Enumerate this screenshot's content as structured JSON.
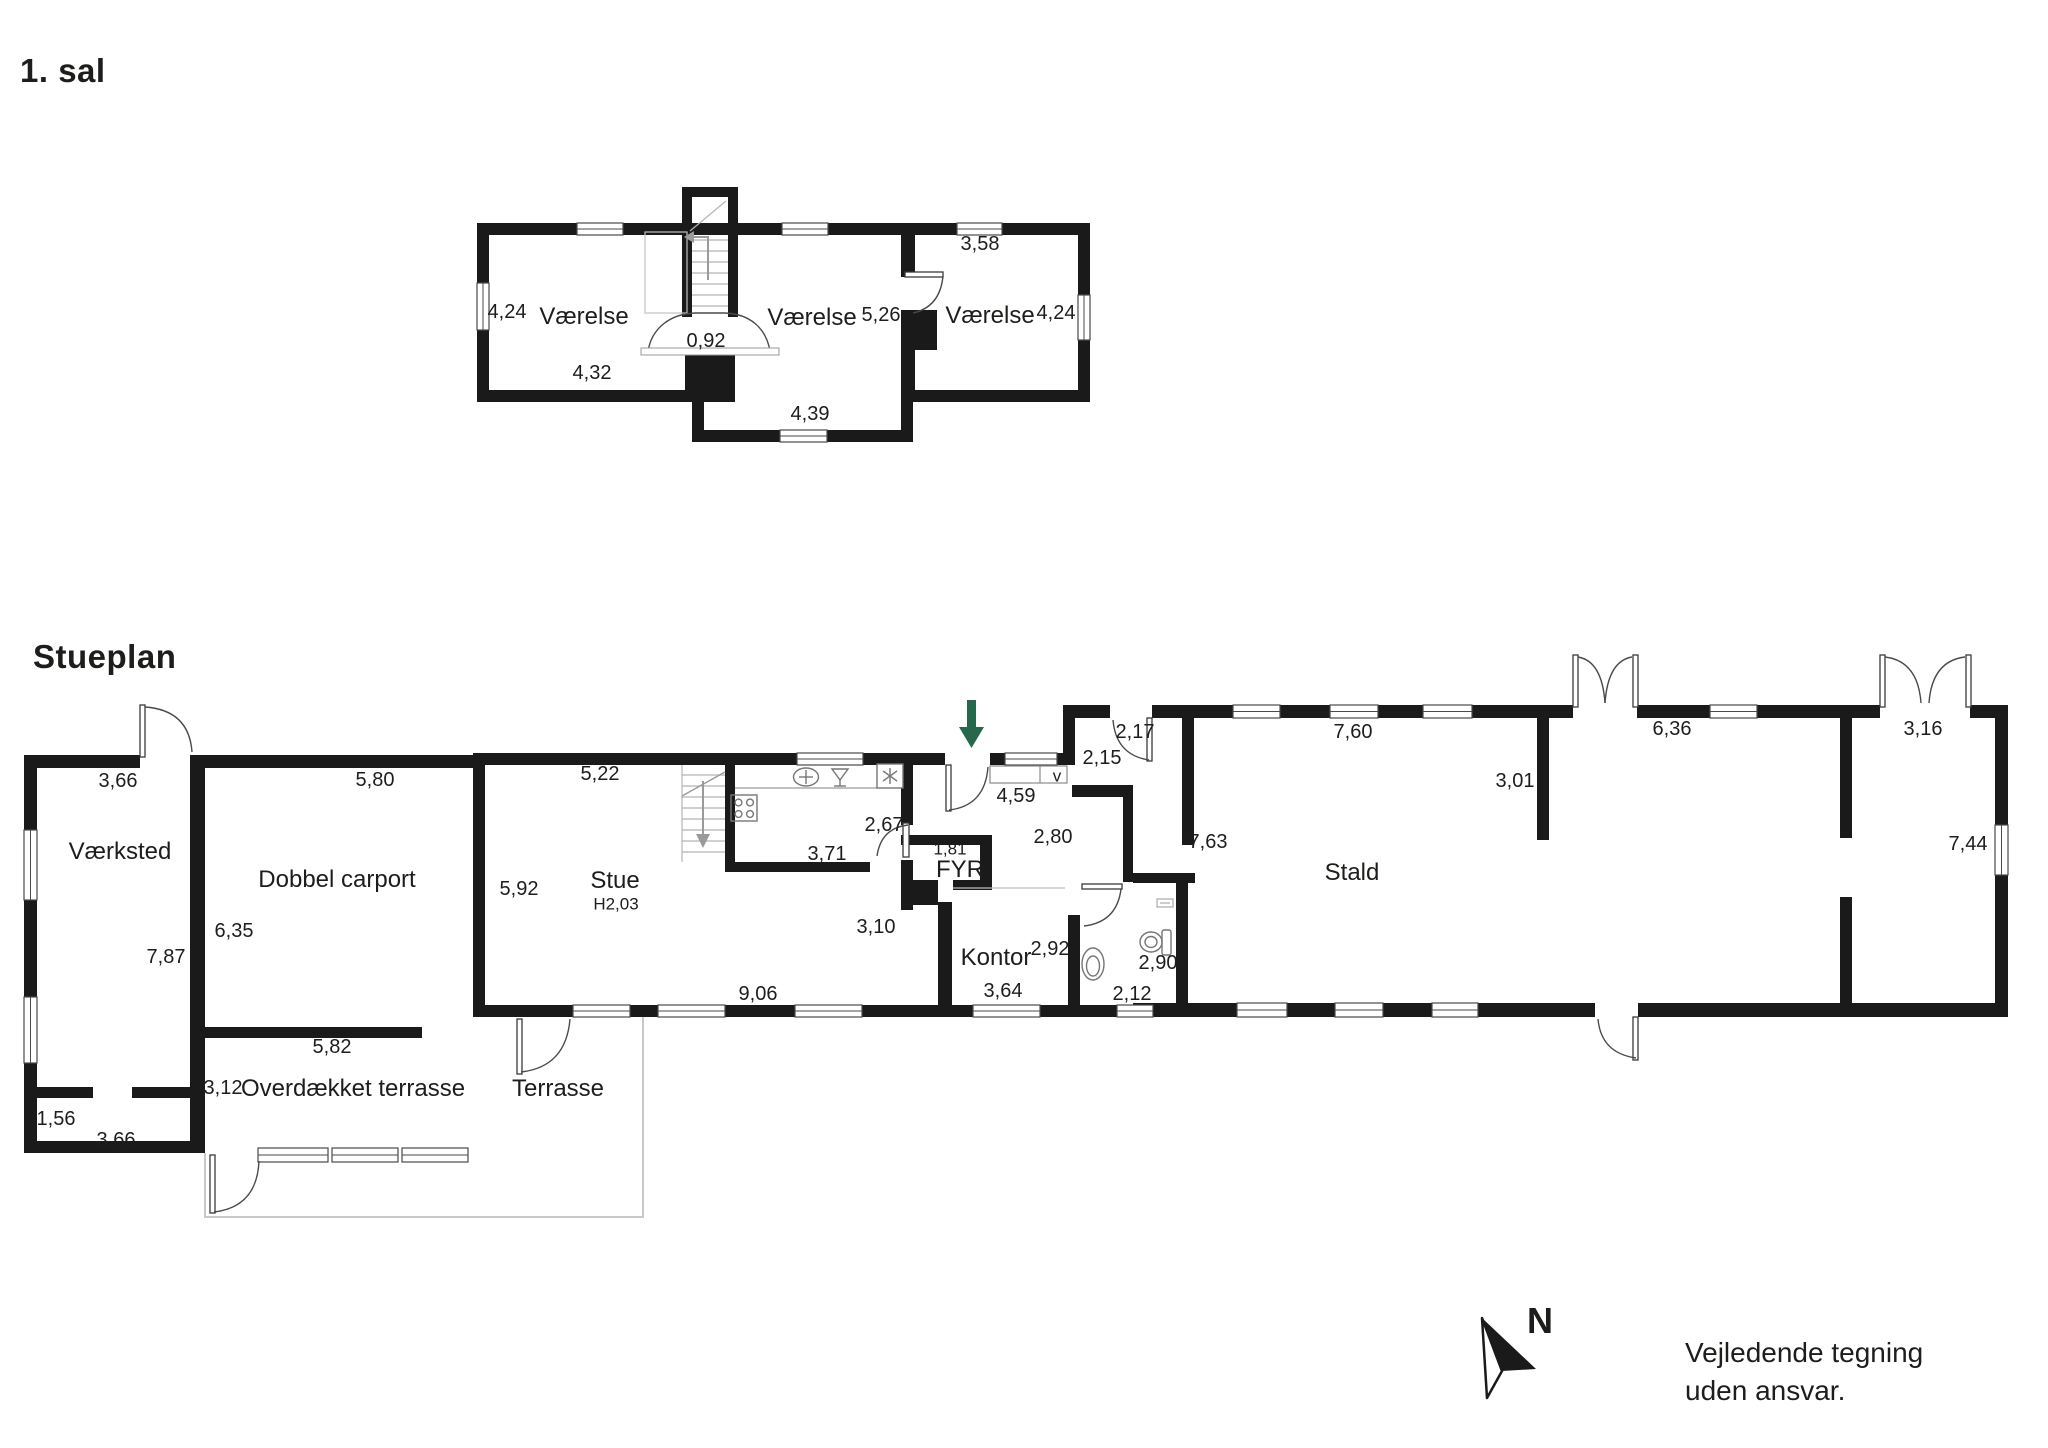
{
  "page": {
    "floor1_title": "1. sal",
    "ground_title": "Stueplan",
    "disclaimer_line1": "Vejledende tegning",
    "disclaimer_line2": "uden ansvar.",
    "north_label": "N"
  },
  "colors": {
    "ink": "#1d1d1b",
    "wall": "#1a1a1a",
    "line_gray": "#9a9a9a",
    "light_gray": "#c9c9c9",
    "green_arrow": "#25684b"
  },
  "floor1_labels": [
    {
      "name": "dim-left-height",
      "kind": "dim",
      "text": "4,24",
      "x": 507,
      "y": 312
    },
    {
      "name": "room-vaerelse-left",
      "kind": "room",
      "text": "Værelse",
      "x": 584,
      "y": 317
    },
    {
      "name": "dim-stair-door",
      "kind": "dim",
      "text": "0,92",
      "x": 706,
      "y": 341
    },
    {
      "name": "room-vaerelse-middle",
      "kind": "room",
      "text": "Værelse",
      "x": 812,
      "y": 318
    },
    {
      "name": "dim-middle-width",
      "kind": "dim",
      "text": "5,26",
      "x": 881,
      "y": 315
    },
    {
      "name": "dim-right-top",
      "kind": "dim",
      "text": "3,58",
      "x": 980,
      "y": 244
    },
    {
      "name": "room-vaerelse-right",
      "kind": "room",
      "text": "Værelse",
      "x": 990,
      "y": 316
    },
    {
      "name": "dim-right-height",
      "kind": "dim",
      "text": "4,24",
      "x": 1056,
      "y": 313
    },
    {
      "name": "dim-left-width",
      "kind": "dim",
      "text": "4,32",
      "x": 592,
      "y": 373
    },
    {
      "name": "dim-hall-width",
      "kind": "dim",
      "text": "4,39",
      "x": 810,
      "y": 414
    }
  ],
  "ground_labels": [
    {
      "name": "dim-vaerksted-top",
      "kind": "dim",
      "text": "3,66",
      "x": 118,
      "y": 781
    },
    {
      "name": "room-vaerksted",
      "kind": "room",
      "text": "Værksted",
      "x": 120,
      "y": 852
    },
    {
      "name": "dim-vaerksted-height",
      "kind": "dim",
      "text": "7,87",
      "x": 166,
      "y": 957
    },
    {
      "name": "dim-entry-width",
      "kind": "dim",
      "text": "1,56",
      "x": 56,
      "y": 1119
    },
    {
      "name": "dim-vaerksted-bottom",
      "kind": "dim",
      "text": "3,66",
      "x": 116,
      "y": 1140
    },
    {
      "name": "dim-terrasse-height",
      "kind": "dim",
      "text": "3,12",
      "x": 223,
      "y": 1088
    },
    {
      "name": "dim-carport-top",
      "kind": "dim",
      "text": "5,80",
      "x": 375,
      "y": 780
    },
    {
      "name": "room-carport",
      "kind": "room",
      "text": "Dobbel carport",
      "x": 337,
      "y": 880
    },
    {
      "name": "dim-carport-height",
      "kind": "dim",
      "text": "6,35",
      "x": 234,
      "y": 931
    },
    {
      "name": "dim-terrasse-width",
      "kind": "dim",
      "text": "5,82",
      "x": 332,
      "y": 1047
    },
    {
      "name": "room-overdaekket-terrasse",
      "kind": "room",
      "text": "Overdækket terrasse",
      "x": 353,
      "y": 1089
    },
    {
      "name": "room-terrasse",
      "kind": "room",
      "text": "Terrasse",
      "x": 558,
      "y": 1089
    },
    {
      "name": "dim-stue-top",
      "kind": "dim",
      "text": "5,22",
      "x": 600,
      "y": 774
    },
    {
      "name": "dim-stue-height",
      "kind": "dim",
      "text": "5,92",
      "x": 519,
      "y": 889
    },
    {
      "name": "room-stue",
      "kind": "room",
      "text": "Stue",
      "x": 615,
      "y": 881
    },
    {
      "name": "dim-stue-ceiling",
      "kind": "sub",
      "text": "H2,03",
      "x": 616,
      "y": 904
    },
    {
      "name": "dim-kitchen-width",
      "kind": "dim",
      "text": "3,71",
      "x": 827,
      "y": 854
    },
    {
      "name": "dim-kitchen-depth",
      "kind": "dim",
      "text": "2,67",
      "x": 884,
      "y": 825
    },
    {
      "name": "dim-stue-bottom",
      "kind": "dim",
      "text": "9,06",
      "x": 758,
      "y": 994
    },
    {
      "name": "dim-stue-opening",
      "kind": "dim",
      "text": "3,10",
      "x": 876,
      "y": 927
    },
    {
      "name": "dim-fyr-width",
      "kind": "sub",
      "text": "1,81",
      "x": 950,
      "y": 849
    },
    {
      "name": "room-fyr",
      "kind": "room",
      "text": "FYR",
      "x": 960,
      "y": 870
    },
    {
      "name": "dim-hall-width",
      "kind": "dim",
      "text": "4,59",
      "x": 1016,
      "y": 796
    },
    {
      "name": "wardrobe-mark",
      "kind": "sub",
      "text": "v",
      "x": 1057,
      "y": 776
    },
    {
      "name": "dim-hall-depth",
      "kind": "dim",
      "text": "2,80",
      "x": 1053,
      "y": 837
    },
    {
      "name": "dim-entry-a",
      "kind": "dim",
      "text": "2,15",
      "x": 1102,
      "y": 758
    },
    {
      "name": "dim-entry-b",
      "kind": "dim",
      "text": "2,17",
      "x": 1135,
      "y": 732
    },
    {
      "name": "room-kontor",
      "kind": "room",
      "text": "Kontor",
      "x": 996,
      "y": 958
    },
    {
      "name": "dim-kontor-height",
      "kind": "dim",
      "text": "2,92",
      "x": 1050,
      "y": 949
    },
    {
      "name": "dim-kontor-width",
      "kind": "dim",
      "text": "3,64",
      "x": 1003,
      "y": 991
    },
    {
      "name": "dim-bath-width",
      "kind": "dim",
      "text": "2,12",
      "x": 1132,
      "y": 994
    },
    {
      "name": "dim-bath-height",
      "kind": "dim",
      "text": "2,90",
      "x": 1158,
      "y": 963
    },
    {
      "name": "dim-stald-west",
      "kind": "dim",
      "text": "7,63",
      "x": 1208,
      "y": 842
    },
    {
      "name": "dim-stald-top",
      "kind": "dim",
      "text": "7,60",
      "x": 1353,
      "y": 732
    },
    {
      "name": "dim-stald-wall",
      "kind": "dim",
      "text": "3,01",
      "x": 1515,
      "y": 781
    },
    {
      "name": "room-stald",
      "kind": "room",
      "text": "Stald",
      "x": 1352,
      "y": 873
    },
    {
      "name": "dim-stald-mid",
      "kind": "dim",
      "text": "6,36",
      "x": 1672,
      "y": 729
    },
    {
      "name": "dim-stald-doors",
      "kind": "dim",
      "text": "3,16",
      "x": 1923,
      "y": 729
    },
    {
      "name": "dim-stald-east",
      "kind": "dim",
      "text": "7,44",
      "x": 1968,
      "y": 844
    }
  ]
}
